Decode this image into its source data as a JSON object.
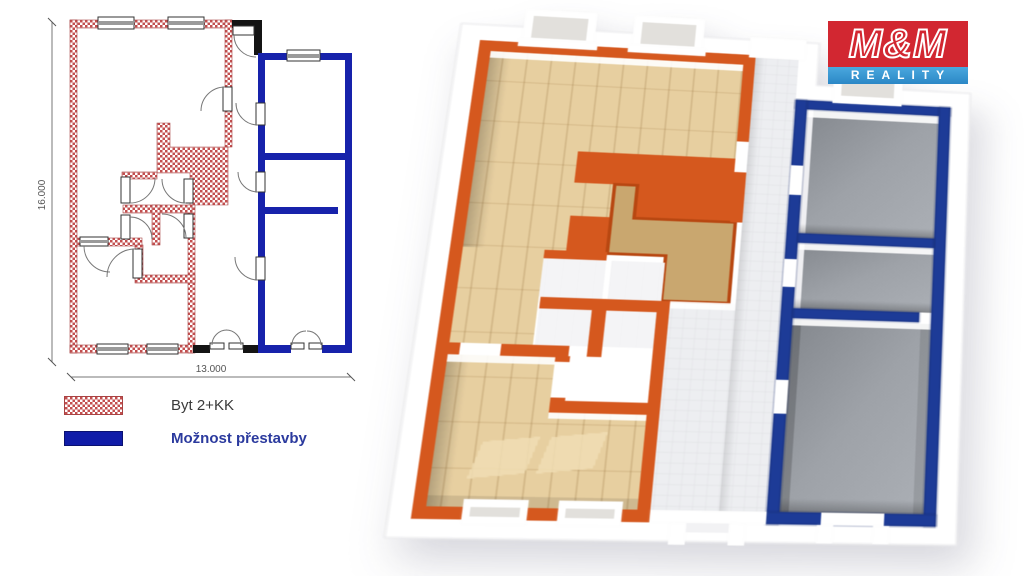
{
  "logo": {
    "title": "M&M",
    "subtitle": "REALITY"
  },
  "plan2d": {
    "dim_height_label": "16.000",
    "dim_width_label": "13.000"
  },
  "legend": {
    "items": [
      {
        "label": "Byt 2+KK",
        "swatch": "hatched-red"
      },
      {
        "label": "Možnost přestavby",
        "swatch": "solid-blue"
      }
    ]
  },
  "colors": {
    "hatch_red": "#C34F4F",
    "hatch_stroke": "#A84444",
    "wall_blue2d": "#1722AB",
    "wall_black": "#141414",
    "dim_color": "#555555",
    "legend_text": "#3A3A3A",
    "legend_blue": "#101CA8",
    "legend_blue_text": "#2B3A9E",
    "orange": "#D5581E",
    "orange_dark": "#B84711",
    "blue3d": "#1D3B97",
    "blue3d_dark": "#142A6B",
    "wood": "#E7CFA0",
    "core_wood": "#C9A76F",
    "gray_floor": "#9DA1A7",
    "tile": "#EDEEF1",
    "tile_line": "#D9DBDF",
    "logo_red": "#D22731",
    "logo_bar1": "#4AA8DE",
    "logo_bar2": "#2B87C6"
  }
}
